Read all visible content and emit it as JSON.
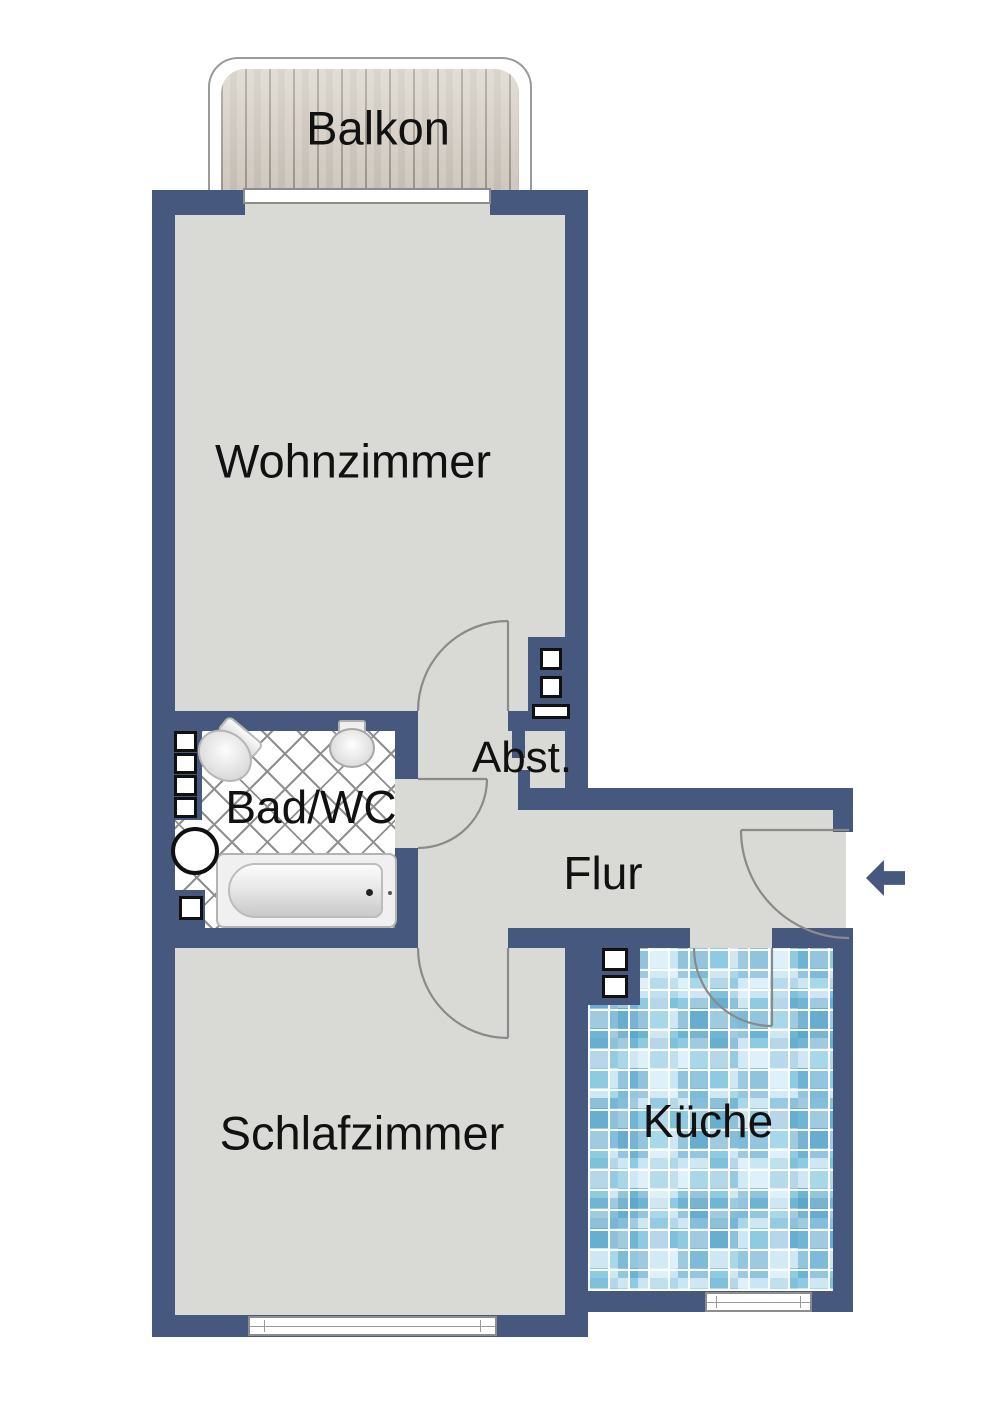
{
  "plan_title": "Apartment floor plan",
  "rooms": {
    "balkon": "Balkon",
    "wohnzimmer": "Wohnzimmer",
    "bad_wc": "Bad/WC",
    "abstellraum": "Abst.",
    "flur": "Flur",
    "schlafzimmer": "Schlafzimmer",
    "kueche": "Küche"
  },
  "entrance": {
    "arrow_direction": "left"
  },
  "colors": {
    "wall": "#46587d",
    "floor": "#d9d9d6",
    "arc": "#8a8a8a",
    "ink": "#111111",
    "wood": "#d9d2c9",
    "wood_line": "#a59b8f",
    "tile_line": "#8f8f8f",
    "kit_light": "#cfe7f3",
    "kit_mid": "#a9d7ea"
  }
}
